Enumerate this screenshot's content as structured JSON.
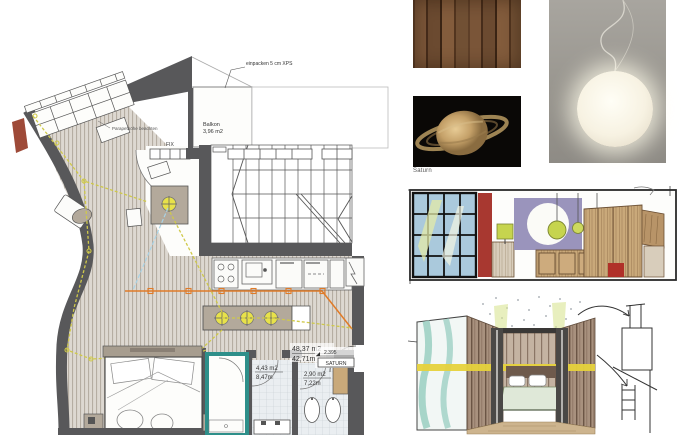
{
  "presentation": {
    "floor_plan": {
      "insulation_note": "einpacken 5 cm XPS",
      "parapet_note": "Parapethöhe beachten",
      "window_label": "FIX",
      "balcony_name": "Balkon",
      "balcony_area": "3,96 m2",
      "living_area": "48,37 m2",
      "living_perimeter": "42,71m",
      "level_mark": "2.395",
      "project_name": "SATURN",
      "bath_large_area": "4,43 m2",
      "bath_large_perimeter": "8,47m",
      "bath_small_area": "2,90 m2",
      "bath_small_perimeter": "7,22m"
    },
    "moodboard": {
      "saturn_caption": "Saturn"
    },
    "colors": {
      "wall_gray": "#58585a",
      "floor_bg": "#ddd8d1",
      "floor_stripe": "#b5ada2",
      "furniture_taupe": "#b3a99b",
      "electric_yellow": "#cfc94a",
      "pendant_yellow": "#e8e24a",
      "plumbing_orange": "#e07b28",
      "teal_accent": "#2e8f8a",
      "insulation_red": "#9e4a38",
      "guide_blue": "#a9d3e6",
      "sketch_red": "#a83830",
      "sketch_lavender": "#9a94bc",
      "sketch_green": "#c6d44e",
      "sketch_wood": "#c9a97a",
      "band_yellow": "#e6d23c"
    }
  }
}
